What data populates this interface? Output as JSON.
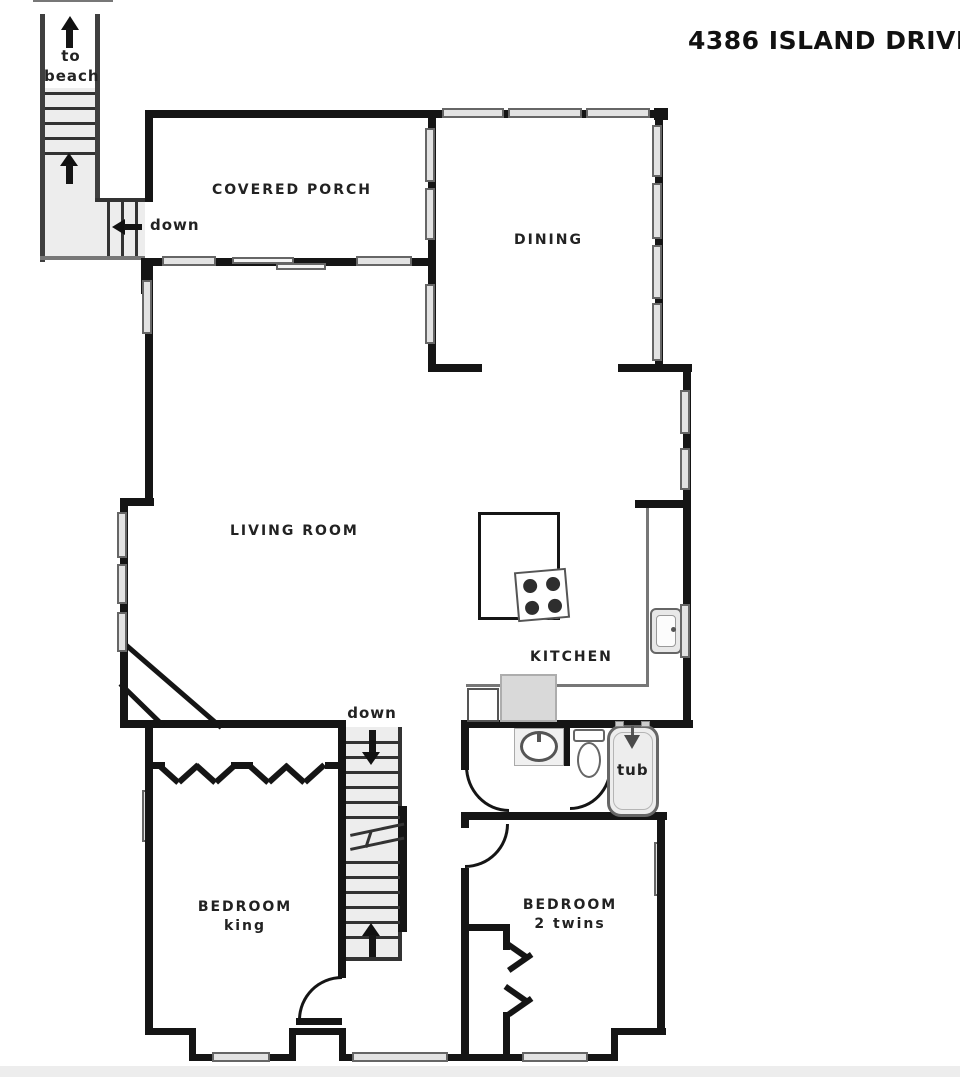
{
  "title": "4386 ISLAND DRIVE",
  "rooms": {
    "covered_porch": "COVERED PORCH",
    "dining": "DINING",
    "living_room": "LIVING ROOM",
    "kitchen": "KITCHEN",
    "bedroom_king": "BEDROOM\nking",
    "bedroom_twins": "BEDROOM\n2 twins"
  },
  "annotations": {
    "to_beach": "to\nbeach",
    "stairs_upper_down": "down",
    "stairs_center_down": "down",
    "tub": "tub"
  },
  "colors": {
    "wall": "#151515",
    "window_fill": "#e3e3e3",
    "window_border": "#666666",
    "stair_fill": "#ededed",
    "text": "#222222"
  }
}
